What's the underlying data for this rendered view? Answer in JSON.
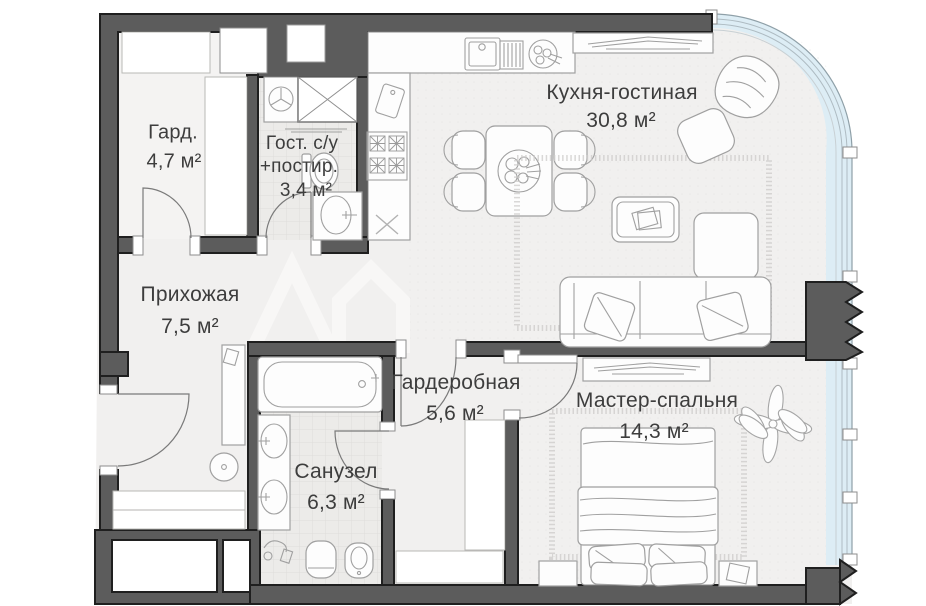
{
  "plan": {
    "type": "apartment-floor-plan",
    "language": "ru",
    "rooms": [
      {
        "name": "Гард.",
        "area": "4,7 м²"
      },
      {
        "name": "Гост. с/у",
        "name2": "+постир.",
        "area": "3,4 м²"
      },
      {
        "name": "Кухня-гостиная",
        "area": "30,8 м²"
      },
      {
        "name": "Прихожая",
        "area": "7,5 м²"
      },
      {
        "name": "Гардеробная",
        "area": "5,6 м²"
      },
      {
        "name": "Санузел",
        "area": "6,3 м²"
      },
      {
        "name": "Мастер-спальня",
        "area": "14,3 м²"
      }
    ],
    "furniture_icons": [
      "wardrobe-hatch",
      "ventilation-shaft",
      "washing-machine",
      "toilet",
      "wall-sink",
      "bathtub",
      "double-vanity",
      "hygienic-shower",
      "bidet",
      "kitchen-sink",
      "dish-drainer",
      "stove",
      "cutting-board",
      "dining-table",
      "dining-chairs",
      "tv-console",
      "armchair",
      "ottoman",
      "coffee-table",
      "corner-sofa",
      "rug",
      "bed",
      "nightstands",
      "plant",
      "console-table",
      "stool",
      "door-swing",
      "curved-glass-facade",
      "wall-break-zigzag",
      "watermark-chevron",
      "watermark-house"
    ]
  },
  "colors": {
    "wall": "#5c5c5c",
    "wallline": "#1f1f1f",
    "glass": "#ddedf5",
    "gframe": "#8fa0a8",
    "floor": "#f1f0ef",
    "tile": "#ecebe9",
    "ink": "#3d3d3d",
    "fstroke": "#a0a0a0",
    "wmark": "#f8f7f6"
  }
}
